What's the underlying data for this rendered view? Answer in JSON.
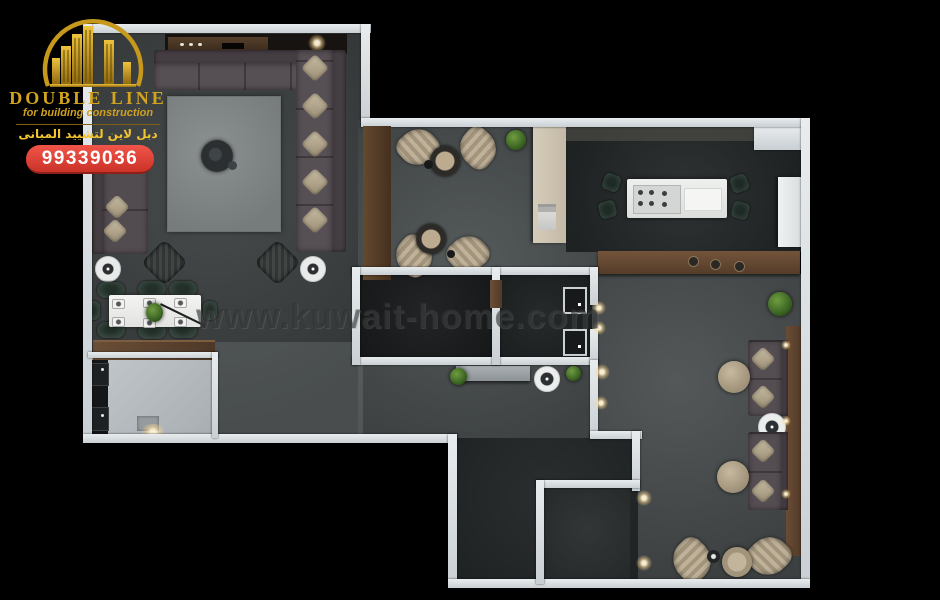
{
  "brand": {
    "name": "DOUBLE LINE",
    "tagline": "for building construction",
    "tagline_arabic": "دبل لاين لتشييد المبانى",
    "phone": "99339036",
    "logo_icon": "buildings-under-arch-icon",
    "colors": {
      "gold": "#d2a41f",
      "badge_red": "#d63a30",
      "badge_text": "#ffffff"
    }
  },
  "watermark": {
    "text": "www.kuwait-home.com"
  },
  "palette": {
    "background": "#000000",
    "wall_white": "#d9dee1",
    "floor_living": "#3f4344",
    "floor_corridor": "#4e5354",
    "floor_kitchen": "#2b2e2f",
    "floor_utility": "#b6bcbf",
    "wood_brown": "#5e4431",
    "sofa_mauve": "#4f484d",
    "cushion_beige": "#b4a78f",
    "chair_green": "#31403a",
    "rug_gray": "#7f8484",
    "island_white": "#e9eae8",
    "plant_green": "#4c7a2d"
  }
}
